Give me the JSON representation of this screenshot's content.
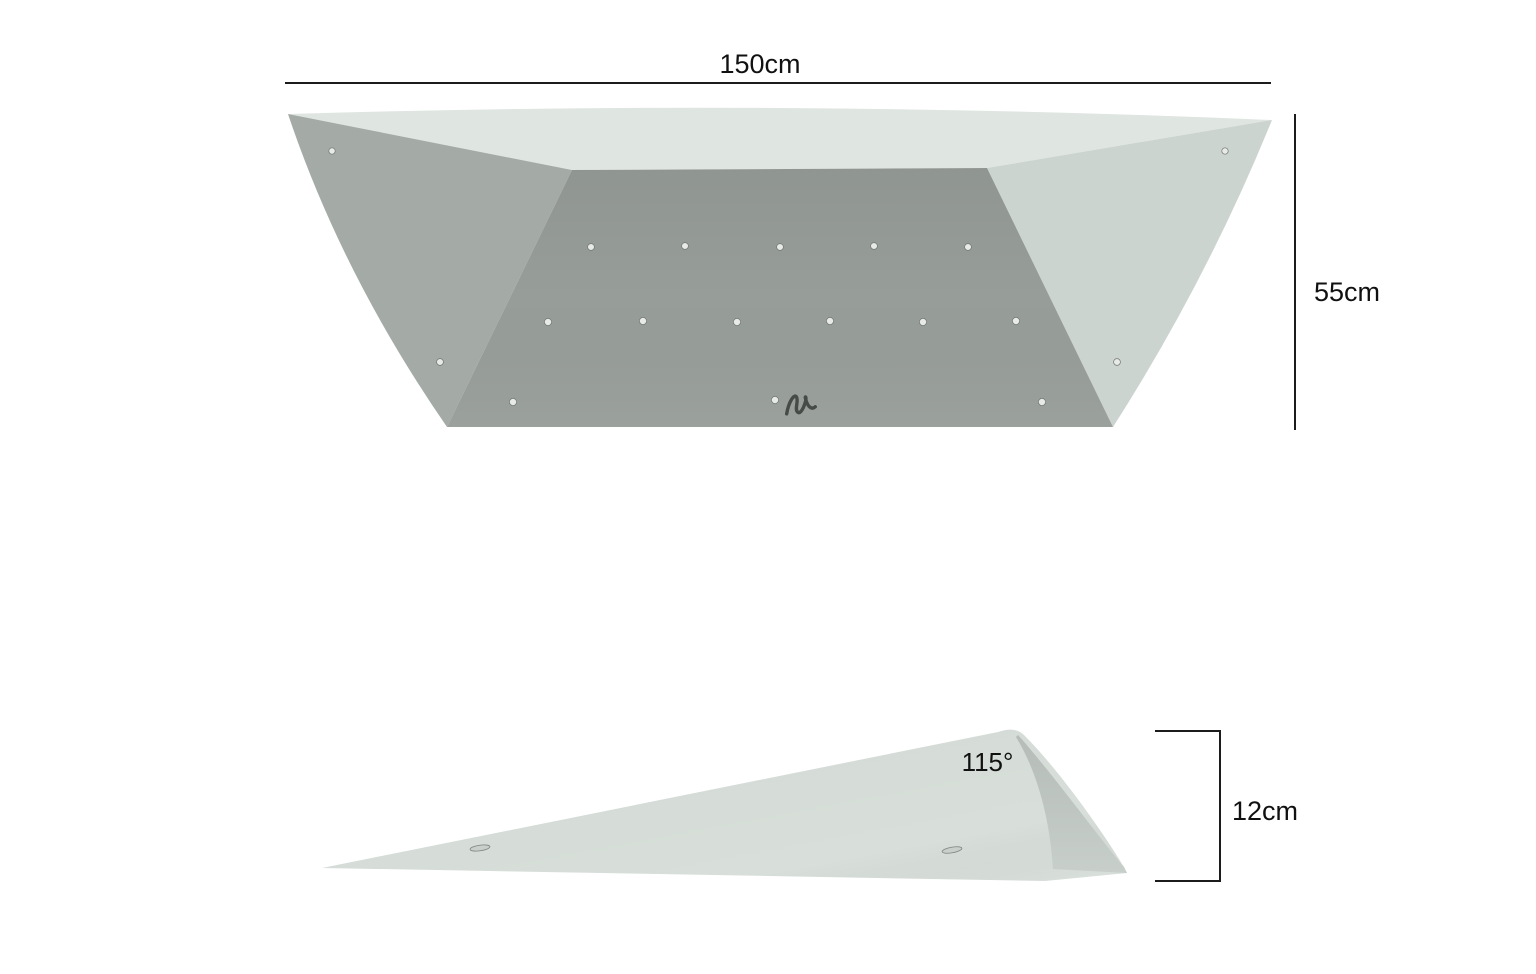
{
  "diagram": {
    "front_view": {
      "width_label": "150cm",
      "height_label": "55cm"
    },
    "side_view": {
      "angle_label": "115°",
      "depth_label": "12cm"
    },
    "colors": {
      "background": "#ffffff",
      "dimension_line": "#1c1c1c",
      "label_text": "#111111",
      "top_face": "#dfe5e1",
      "left_face": "#a4aaa6",
      "main_face": "#979d99",
      "right_face": "#ccd4d0",
      "wedge_face": "#d8dfda",
      "wedge_facet": "#c3cbc6",
      "logo": "#464b48"
    }
  }
}
